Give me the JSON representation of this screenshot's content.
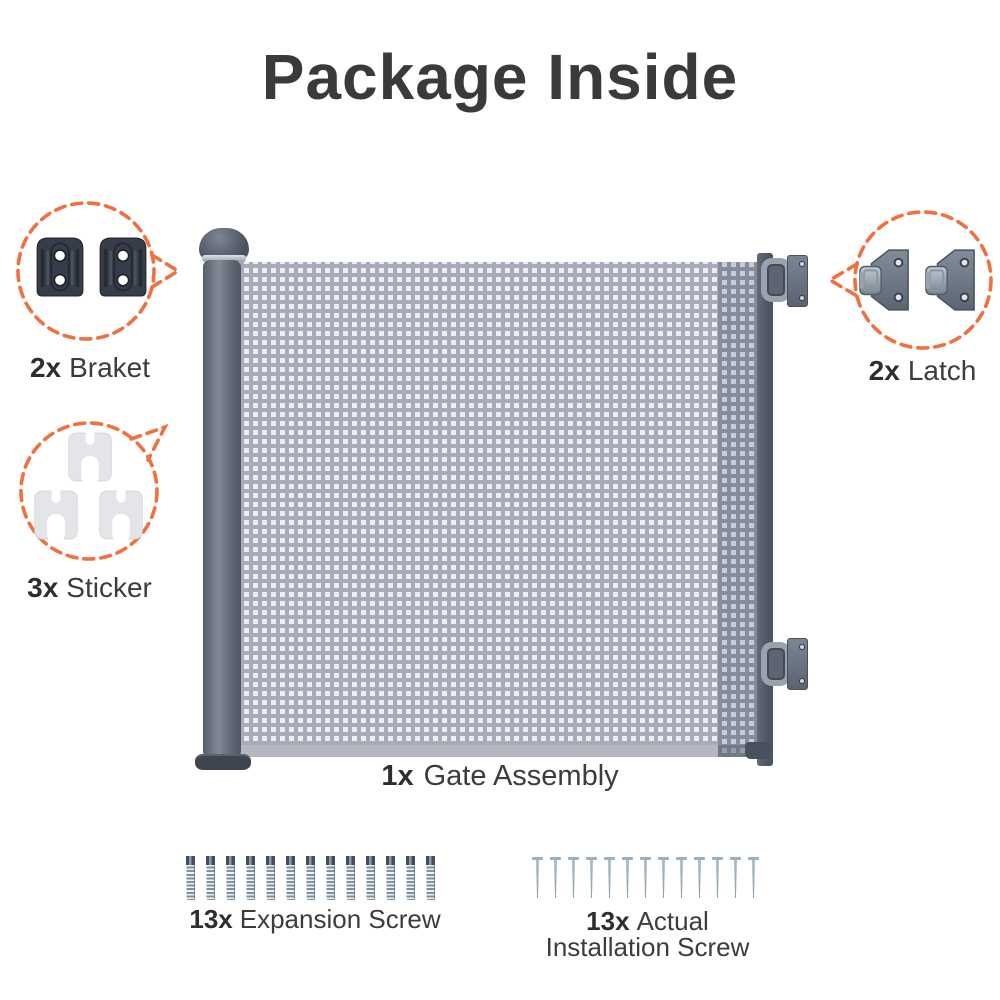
{
  "title": "Package Inside",
  "colors": {
    "accent": "#F0713F",
    "heading": "#3A3A3A",
    "label": "#3C3C3C"
  },
  "callouts": {
    "bracket": {
      "qty": "2x",
      "name": "Braket",
      "count": 2
    },
    "sticker": {
      "qty": "3x",
      "name": "Sticker",
      "count": 3
    },
    "latch": {
      "qty": "2x",
      "name": "Latch",
      "count": 2
    }
  },
  "gate": {
    "qty": "1x",
    "name": "Gate Assembly"
  },
  "screws": {
    "expansion": {
      "qty": "13x",
      "name": "Expansion Screw",
      "count": 13
    },
    "installation": {
      "qty": "13x",
      "name_line1": "Actual",
      "name_line2": "Installation Screw",
      "count": 13
    }
  }
}
